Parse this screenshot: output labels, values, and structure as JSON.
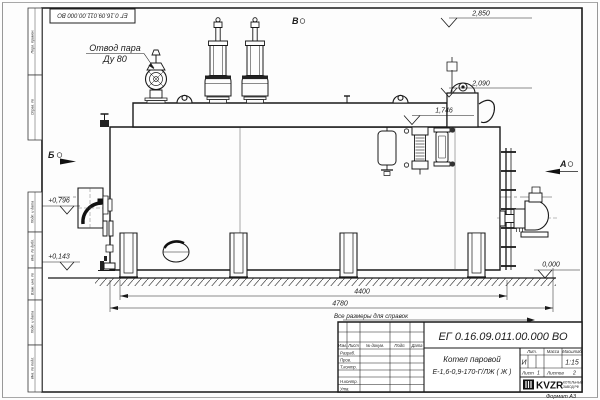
{
  "stamp_top": {
    "doc_number": "ЕГ 0.16.09.011.00.000  ВО"
  },
  "margin_labels": [
    "Перв. примен.",
    "Справ. №",
    "Подп. и дата",
    "Инв. № дубл.",
    "Взам. инв. №",
    "Подп. и дата",
    "Инв. № подл."
  ],
  "annotations": {
    "steam_outlet_line1": "Отвод пара",
    "steam_outlet_line2": "Ду 80"
  },
  "view_markers": {
    "left": "Б",
    "top": "В",
    "right": "А"
  },
  "elevations": {
    "valves_top": "2,850",
    "drum_top": "2,090",
    "body_top": "1,746",
    "burner_axis": "+0,796",
    "drain_level": "+0,143",
    "ground": "0,000"
  },
  "dimensions": {
    "supports_span": "4400",
    "overall_length": "4780"
  },
  "notes": {
    "reference": "Все размеры для справок"
  },
  "title_block": {
    "doc_number": "ЕГ 0.16.09.011.00.000  ВО",
    "product_line1": "Котел паровой",
    "product_line2": "Е-1,6-0,9-170-Г/ЛЖ ( Ж )",
    "col_izm": "Изм.",
    "col_list": "Лист",
    "col_doc": "№ докум.",
    "col_podp": "Подп.",
    "col_data": "Дата",
    "row_razrab": "Разраб.",
    "row_prov": "Пров.",
    "row_tkontr": "Т.контр.",
    "row_nkontr": "Н.контр.",
    "row_utv": "Утв.",
    "hdr_lit": "Лит.",
    "hdr_mass": "Масса",
    "hdr_scale": "Масштаб",
    "lit_value": "И",
    "scale_value": "1:15",
    "sheet_label": "Лист",
    "sheet_value": "1",
    "sheets_label": "Листов",
    "sheets_value": "2",
    "logo": "KVZR",
    "company_line1": "КОТЕЛЬНЫЙ",
    "company_line2": "ЗАВОД РФ",
    "format": "Формат А3"
  }
}
